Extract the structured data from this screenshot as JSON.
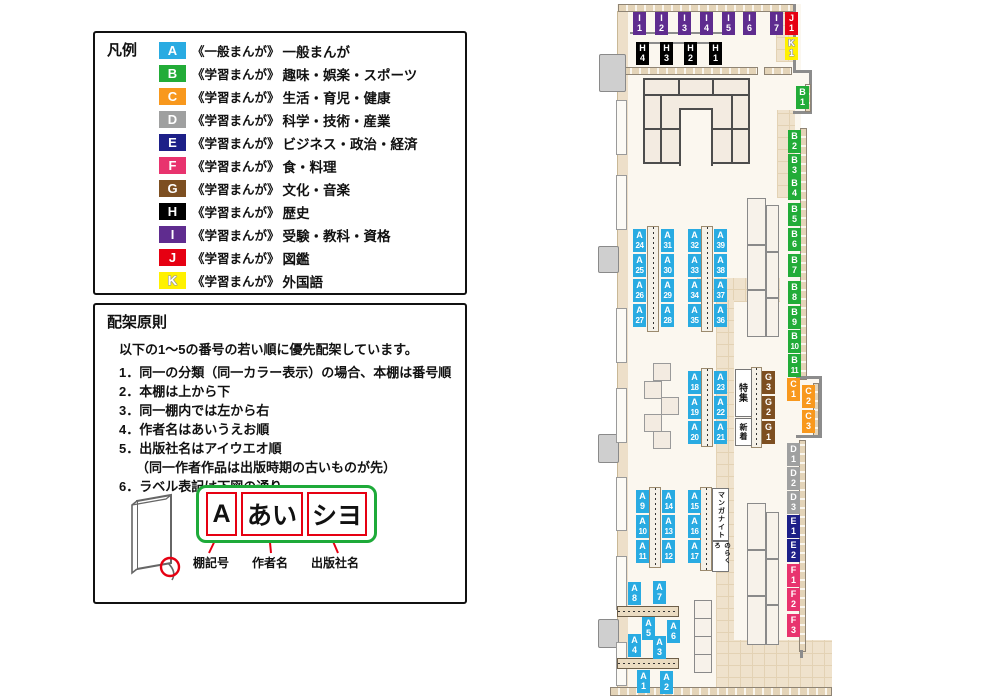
{
  "legend": {
    "title": "凡例",
    "items": [
      {
        "code": "A",
        "color": "#29ABE2",
        "prefix": "《一般まんが》",
        "label": "一般まんが"
      },
      {
        "code": "B",
        "color": "#22AC38",
        "prefix": "《学習まんが》",
        "label": "趣味・娯楽・スポーツ"
      },
      {
        "code": "C",
        "color": "#F8981D",
        "prefix": "《学習まんが》",
        "label": "生活・育児・健康"
      },
      {
        "code": "D",
        "color": "#9FA0A0",
        "prefix": "《学習まんが》",
        "label": "科学・技術・産業"
      },
      {
        "code": "E",
        "color": "#1D2088",
        "prefix": "《学習まんが》",
        "label": "ビジネス・政治・経済"
      },
      {
        "code": "F",
        "color": "#E8336E",
        "prefix": "《学習まんが》",
        "label": "食・料理"
      },
      {
        "code": "G",
        "color": "#7D4F21",
        "prefix": "《学習まんが》",
        "label": "文化・音楽"
      },
      {
        "code": "H",
        "color": "#000000",
        "prefix": "《学習まんが》",
        "label": "歴史"
      },
      {
        "code": "I",
        "color": "#5F2C8F",
        "prefix": "《学習まんが》",
        "label": "受験・教科・資格"
      },
      {
        "code": "J",
        "color": "#E60012",
        "prefix": "《学習まんが》",
        "label": "図鑑"
      },
      {
        "code": "K",
        "color": "#FFF100",
        "prefix": "《学習まんが》",
        "label": "外国語"
      }
    ]
  },
  "principles": {
    "title": "配架原則",
    "intro": "以下の1～5の番号の若い順に優先配架しています。",
    "items": [
      "同一の分類（同一カラー表示）の場合、本棚は番号順",
      "本棚は上から下",
      "同一棚内では左から右",
      "作者名はあいうえお順",
      "出版社名はアイウエオ順",
      "ラベル表記は下図の通り"
    ],
    "note_after_item_5": "（同一作者作品は出版時期の古いものが先）"
  },
  "label_diagram": {
    "boxes": [
      "A",
      "あい",
      "シヨ"
    ],
    "captions": [
      "棚記号",
      "作者名",
      "出版社名"
    ]
  },
  "map": {
    "categories": {
      "A": "#29ABE2",
      "B": "#22AC38",
      "C": "#F8981D",
      "D": "#9FA0A0",
      "E": "#1D2088",
      "F": "#E8336E",
      "G": "#7D4F21",
      "H": "#000000",
      "I": "#5F2C8F",
      "J": "#E60012",
      "K": "#FFF100"
    },
    "shelf_labels": [
      "I1",
      "I2",
      "I3",
      "I4",
      "I5",
      "I6",
      "I7",
      "J1",
      "K1",
      "H4",
      "H3",
      "H2",
      "H1",
      "B1",
      "B2",
      "B3",
      "B4",
      "B5",
      "B6",
      "B7",
      "B8",
      "B9",
      "B10",
      "B11",
      "C1",
      "C2",
      "C3",
      "D1",
      "D2",
      "D3",
      "E1",
      "E2",
      "F1",
      "F2",
      "F3",
      "G3",
      "G2",
      "G1",
      "A24",
      "A25",
      "A26",
      "A27",
      "A31",
      "A30",
      "A29",
      "A28",
      "A32",
      "A33",
      "A34",
      "A35",
      "A39",
      "A38",
      "A37",
      "A36",
      "A18",
      "A19",
      "A20",
      "A23",
      "A22",
      "A21",
      "A9",
      "A10",
      "A11",
      "A14",
      "A13",
      "A12",
      "A15",
      "A16",
      "A17",
      "A8",
      "A7",
      "A5",
      "A6",
      "A4",
      "A3",
      "A1",
      "A2"
    ],
    "area_boxes": [
      "特集",
      "新着",
      "マンガナイト",
      "のらくろ"
    ]
  }
}
